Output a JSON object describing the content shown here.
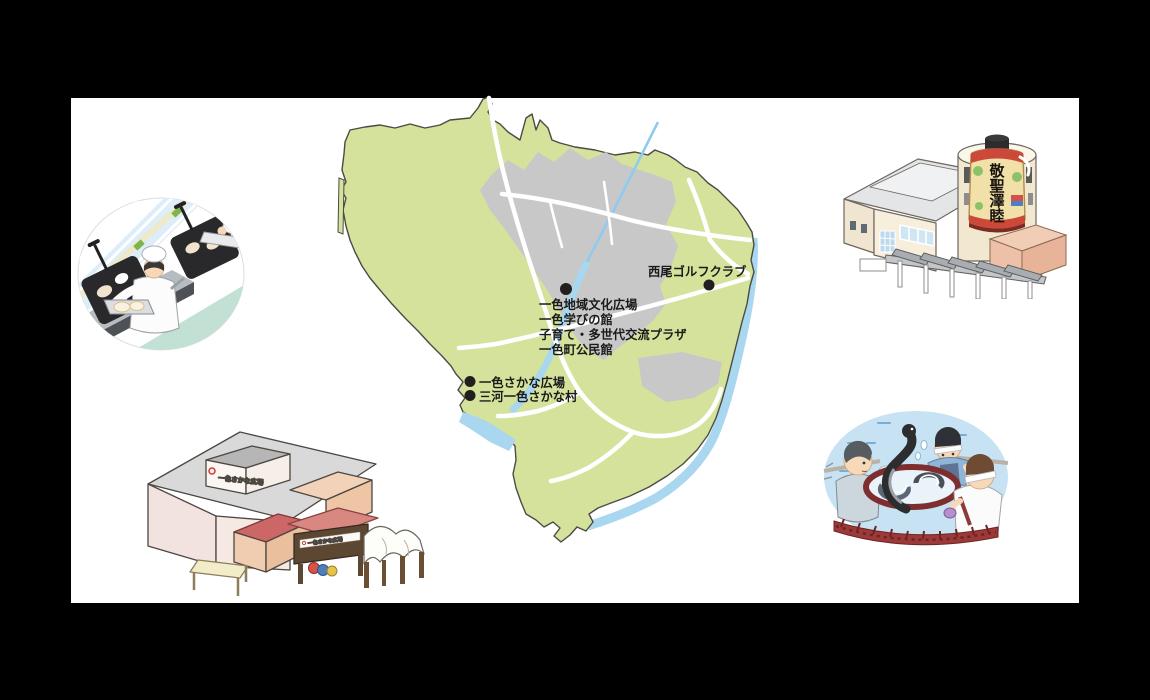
{
  "page": {
    "background": "#000000",
    "panel_background": "#ffffff"
  },
  "map": {
    "colors": {
      "land": "#d5e29b",
      "urban": "#c8c8c8",
      "water": "#a9d7f0",
      "river": "#8ecbee",
      "road": "#ffffff",
      "coast_outline": "#4b4b45",
      "marker": "#231f1f",
      "label": "#1a1a1a"
    },
    "labels": {
      "golf": "西尾ゴルフクラブ",
      "facilities": [
        "一色地域文化広場",
        "一色学びの館",
        "子育て・多世代交流プラザ",
        "一色町公民館"
      ],
      "fish_plaza": "一色さかな広場",
      "fish_village": "三河一色さかな村"
    }
  },
  "illustrations": {
    "eel_grilling": {
      "name": "eel-grilling-kitchen"
    },
    "lantern_hall": {
      "name": "giant-lantern-hall",
      "lantern_chars": [
        "敬",
        "聖",
        "澤",
        "睦"
      ]
    },
    "fish_market": {
      "name": "isshiki-fish-market",
      "roof_sign": "一色さかな広場",
      "gate_sign": "一色さかな広場"
    },
    "eel_harvest": {
      "name": "eel-harvest-scene"
    }
  }
}
